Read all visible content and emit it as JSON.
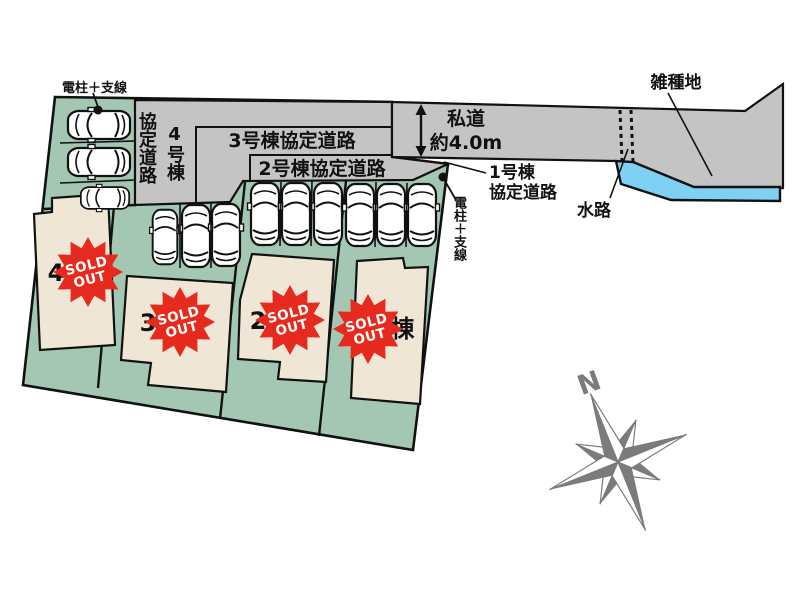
{
  "site": {
    "pole_label_top": "電柱＋支線",
    "pole_label_right": "電柱＋支線",
    "north_label": "N",
    "roads": {
      "road4_col1": "4号棟",
      "road4_col2": "協定道路",
      "road3": "3号棟協定道路",
      "road2": "2号棟協定道路",
      "road1_line1": "1号棟",
      "road1_line2": "協定道路",
      "private_road": "私道",
      "private_road_width": "約4.0m"
    },
    "areas": {
      "misc_land": "雑種地",
      "waterway": "水路"
    },
    "plots": [
      {
        "name": "4号棟",
        "stamp_line1": "SOLD",
        "stamp_line2": "OUT"
      },
      {
        "name": "3号棟",
        "stamp_line1": "SOLD",
        "stamp_line2": "OUT"
      },
      {
        "name": "2号棟",
        "stamp_line1": "SOLD",
        "stamp_line2": "OUT"
      },
      {
        "name": "1号棟",
        "stamp_line1": "SOLD",
        "stamp_line2": "OUT"
      }
    ],
    "colors": {
      "plot_green": "#a4c7b3",
      "road_gray": "#c4c4c4",
      "house_beige": "#efe6d6",
      "stamp_red": "#e72a1e",
      "water_blue": "#7fd1f3",
      "compass_gray": "#7b7b7b",
      "outline_black": "#111111"
    }
  }
}
